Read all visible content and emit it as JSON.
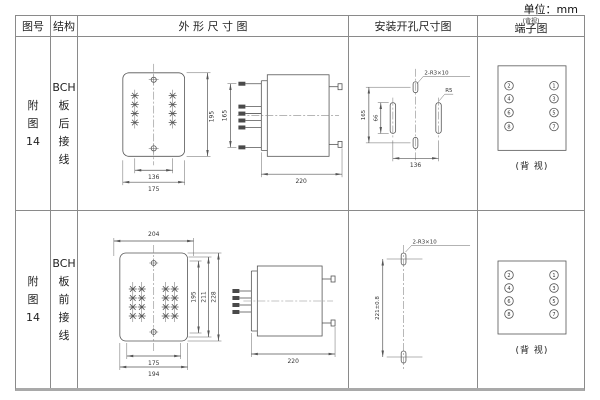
{
  "page": {
    "unit_label": "单位：mm"
  },
  "header": {
    "figure_no": "图号",
    "structure": "结构",
    "outline": "外 形 尺 寸 图",
    "mounting": "安装开孔尺寸图",
    "terminal": "端子图",
    "terminal_note": "(背视)"
  },
  "rows": [
    {
      "figure_lines": [
        "附",
        "图",
        "14"
      ],
      "structure_lines": [
        "BCH",
        "板",
        "后",
        "接",
        "线"
      ],
      "outline": {
        "front_height": "195",
        "front_width_inner": "136",
        "front_width_outer": "175",
        "side_height": "165",
        "side_depth": "220"
      },
      "mounting": {
        "slot_label": "2-R3×10",
        "corner_label": "R5",
        "height": "165",
        "slot_length": "66",
        "width": "136"
      },
      "terminal": {
        "left": [
          "2",
          "4",
          "6",
          "8"
        ],
        "right": [
          "1",
          "3",
          "5",
          "7"
        ],
        "caption": "(背 视)"
      }
    },
    {
      "figure_lines": [
        "附",
        "图",
        "14"
      ],
      "structure_lines": [
        "BCH",
        "板",
        "前",
        "接",
        "线"
      ],
      "outline": {
        "top_width": "204",
        "front_width_inner": "175",
        "front_width_outer": "194",
        "height_inner": "195",
        "height_mid": "211",
        "height_outer": "228",
        "side_depth": "220"
      },
      "mounting": {
        "slot_label": "2-R3×10",
        "height": "221±0.8"
      },
      "terminal": {
        "left": [
          "2",
          "4",
          "6",
          "8"
        ],
        "right": [
          "1",
          "3",
          "5",
          "7"
        ],
        "caption": "(背 视)"
      }
    }
  ]
}
